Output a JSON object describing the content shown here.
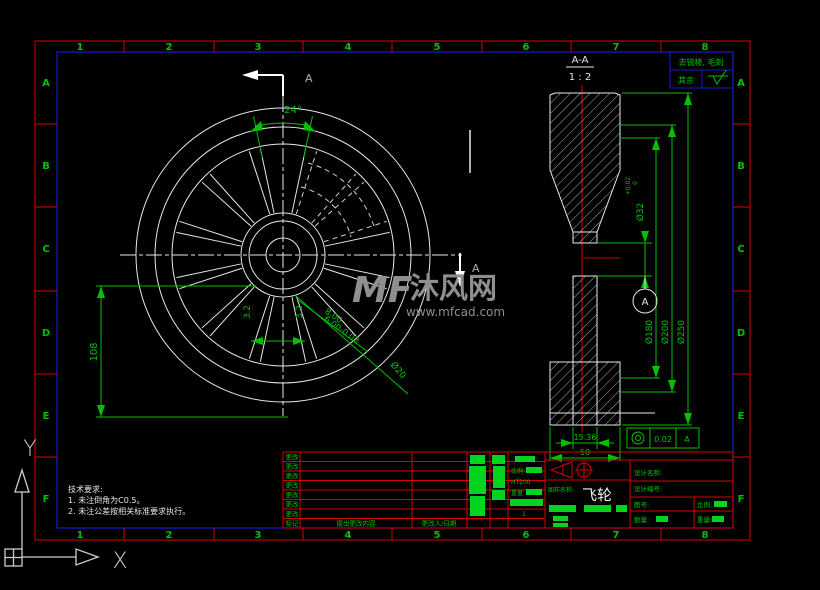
{
  "grid": {
    "cols": [
      "1",
      "2",
      "3",
      "4",
      "5",
      "6",
      "7",
      "8"
    ],
    "rows": [
      "A",
      "B",
      "C",
      "D",
      "E",
      "F"
    ]
  },
  "note_box": {
    "line1": "去锐棱, 毛刺",
    "other": "其余"
  },
  "front": {
    "cut_label": "A",
    "dims": {
      "angle": "24°",
      "height": "108",
      "hole": "Ø20",
      "depth_a": "8.00",
      "depth_b": "6.00-0.03",
      "w1": "3.2",
      "w2": "3.2"
    }
  },
  "section": {
    "view_label": "A-A",
    "view_scale": "1 : 2",
    "datum": "A",
    "dims": {
      "bore": "Ø32",
      "tol_up": "+0.02",
      "tol_dn": "0",
      "d1": "Ø180",
      "d2": "Ø200",
      "d3": "Ø250",
      "hub": "15.36",
      "width": "50"
    },
    "gdt": {
      "value": "0.02",
      "datum": "A"
    }
  },
  "revision": {
    "row": "更改",
    "mark": "标记",
    "content": "提出更改内容",
    "person": "更改人/日期"
  },
  "title_block": {
    "name_label": "图样名称:",
    "part_name": "飞轮",
    "field1": "设计名称:",
    "field2": "设计编号:",
    "field3": "图号:",
    "scale_label": "比例:",
    "qty_label": "数量:",
    "weight_label": "重量:",
    "material": "HT200",
    "param_scale": "比例",
    "param_weight": "重量",
    "count": "1"
  },
  "notes": {
    "title": "技术要求:",
    "line1": "1. 未注倒角为C0.5。",
    "line2": "2. 未注公差按相关标准要求执行。"
  },
  "watermark": {
    "logo": "MF",
    "brand": "沐风网",
    "url": "www.mfcad.com"
  },
  "ucs": {
    "x": "X",
    "y": "Y"
  },
  "colors": {
    "red": "#d40000",
    "blue": "#1a1acc",
    "green": "#00c000",
    "white": "#e8e8e8",
    "gray": "#8f8f8f"
  }
}
